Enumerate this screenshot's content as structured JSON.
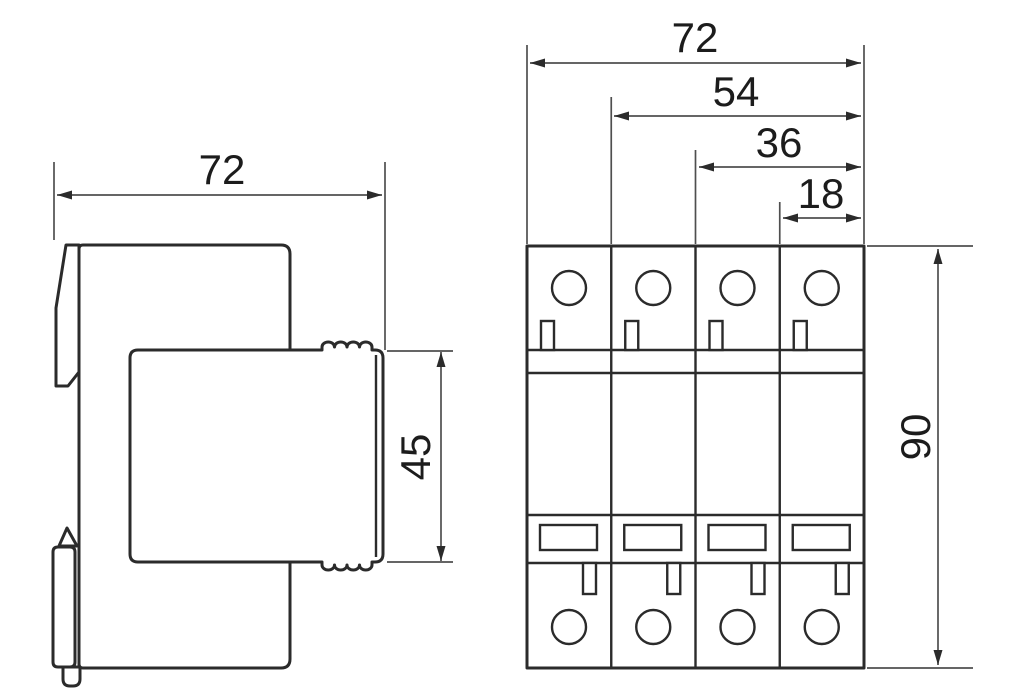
{
  "drawing": {
    "type": "technical-dimension-drawing",
    "subject": "4-module DIN-rail surge protection device, side view and front view with millimetre dimensions",
    "background_color": "#ffffff",
    "outline_color": "#2b2b2b",
    "dimension_line_color": "#4f4f4f",
    "side_view": {
      "name": "side-view",
      "labels": {
        "overall_width": "72",
        "plug_module_height": "45"
      }
    },
    "front_view": {
      "name": "front-view",
      "module_count": 4,
      "labels": {
        "overall_width": "72",
        "three_module_width": "54",
        "two_module_width": "36",
        "one_module_width": "18",
        "overall_height": "90"
      }
    }
  }
}
